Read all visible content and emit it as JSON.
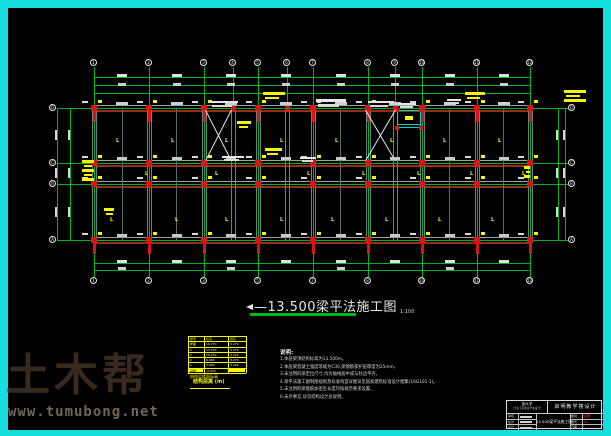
{
  "colors": {
    "frame": "#17dede",
    "bg": "#000000",
    "green": "#00b41e",
    "beam_red": "#9c2a1a",
    "beam_gray": "#93a7a7",
    "v_beam": "#5f8585",
    "column_red": "#d81414",
    "yellow": "#f6f600",
    "white": "#e8e8e8",
    "accent_cyan": "#00d2d2",
    "red_text": "#ff3c3c",
    "brand_brown": "#3a2a1e",
    "url_gray": "#6e6757"
  },
  "title": {
    "text": "—13.500梁平法施工图",
    "scale": "1:100"
  },
  "plan": {
    "left": 94,
    "right": 530,
    "top": 108,
    "bottom": 240,
    "top_bubble_y": 63,
    "bot_bubble_y": 281,
    "left_bubble_x": 53,
    "right_bubble_x": 572,
    "top_dim_ys": [
      77,
      85,
      93
    ],
    "bottom_dim_ys": [
      263,
      270
    ],
    "left_dim_xs": [
      57,
      70
    ],
    "right_dim_xs": [
      558,
      565
    ],
    "top_axes": [
      {
        "x": 94,
        "label": "1",
        "main": true
      },
      {
        "x": 149,
        "label": "2",
        "main": true
      },
      {
        "x": 204,
        "label": "3",
        "main": true
      },
      {
        "x": 233,
        "label": "4",
        "main": false
      },
      {
        "x": 258,
        "label": "5",
        "main": true
      },
      {
        "x": 287,
        "label": "6",
        "main": false
      },
      {
        "x": 313,
        "label": "7",
        "main": true
      },
      {
        "x": 368,
        "label": "8",
        "main": true
      },
      {
        "x": 395,
        "label": "9",
        "main": false
      },
      {
        "x": 422,
        "label": "10",
        "main": true
      },
      {
        "x": 477,
        "label": "11",
        "main": true
      },
      {
        "x": 530,
        "label": "12",
        "main": true
      }
    ],
    "bottom_axis_labels": [
      "1",
      "2",
      "3",
      "5",
      "7",
      "8",
      "10",
      "11",
      "12"
    ],
    "rows": [
      {
        "y": 108,
        "label": "D"
      },
      {
        "y": 163,
        "label": "C"
      },
      {
        "y": 184,
        "label": "B"
      },
      {
        "y": 240,
        "label": "A"
      }
    ],
    "mid_beams_x": [
      122,
      176,
      340,
      449,
      503
    ],
    "stair_crosses": [
      {
        "x1": 206,
        "y1": 110,
        "x2": 232,
        "y2": 161
      },
      {
        "x1": 366,
        "y1": 110,
        "x2": 396,
        "y2": 161
      }
    ],
    "stair_box": {
      "x": 397,
      "y": 110,
      "w": 24,
      "h": 18
    },
    "yellow_leaders": [
      [
        263,
        92,
        22,
        9
      ],
      [
        465,
        92,
        20,
        9
      ],
      [
        564,
        90,
        22,
        13
      ],
      [
        237,
        121,
        14,
        9
      ],
      [
        265,
        148,
        17,
        9
      ],
      [
        82,
        160,
        12,
        24
      ],
      [
        524,
        166,
        6,
        13
      ],
      [
        104,
        208,
        10,
        9
      ]
    ],
    "yellow_glyph_rows": [
      {
        "y": 138,
        "glyph": "L",
        "xs": [
          116,
          171,
          225,
          280,
          335,
          390,
          443,
          498
        ]
      },
      {
        "y": 171,
        "glyph": "L",
        "xs": [
          145,
          215,
          307,
          362,
          417,
          470,
          522
        ]
      },
      {
        "y": 217,
        "glyph": "L",
        "xs": [
          110,
          175,
          225,
          280,
          331,
          385,
          438,
          491
        ]
      }
    ],
    "white_clusters": [
      [
        316,
        99,
        30,
        8
      ],
      [
        210,
        101,
        28,
        6
      ],
      [
        368,
        101,
        26,
        6
      ],
      [
        398,
        103,
        18,
        5
      ],
      [
        222,
        156,
        22,
        5
      ],
      [
        300,
        157,
        16,
        4
      ],
      [
        447,
        99,
        14,
        4
      ]
    ]
  },
  "legend": {
    "headers": [
      "层号",
      "标高",
      "层高"
    ],
    "rows": [
      [
        "屋面",
        "16.770",
        "3.270"
      ],
      [
        "4",
        "13.500",
        "3.270"
      ],
      [
        "3",
        "10.230",
        "3.270"
      ],
      [
        "2",
        "6.960",
        "3.270"
      ],
      [
        "1",
        "3.690",
        "3.240"
      ],
      [
        "基础",
        "-0.050",
        ""
      ]
    ],
    "caption1": "结构层楼面标高",
    "caption2": "结构层高 (m)"
  },
  "notes": {
    "heading": "说明:",
    "lines": [
      "1.本层梁顶结构标高为13.500m。",
      "2.本层梁混凝土强度等级为C30,梁钢筋保护层厚度为25mm。",
      "3.未注明的梁定位尺寸,均为轴线居中或与柱边平齐。",
      "4.梁平法施工图制图规则及标准构造详图详见国家建筑标准设计图集(16G101-1)。",
      "5.未注明的梁箍筋加密区长度均按规范要求设置。",
      "6.未尽事宜,详见结构设计总说明。"
    ]
  },
  "title_block": {
    "org_line1": "某大学",
    "org_line2": "(土木工程专业毕业设计)",
    "project": "启明教学楼设计",
    "drawing": "13.500梁平法施工图",
    "rows": [
      {
        "label": "审核",
        "value": "",
        "rlabel": "图别",
        "rvalue": "结施",
        "red": true
      },
      {
        "label": "校对",
        "value": "",
        "rlabel": "图号",
        "rvalue": "21",
        "red": true
      },
      {
        "label": "设计",
        "value": "",
        "rlabel": "日期",
        "rvalue": "",
        "red": false
      }
    ]
  },
  "watermark": {
    "brand": "土木帮",
    "url": "www.tumubong.net"
  }
}
